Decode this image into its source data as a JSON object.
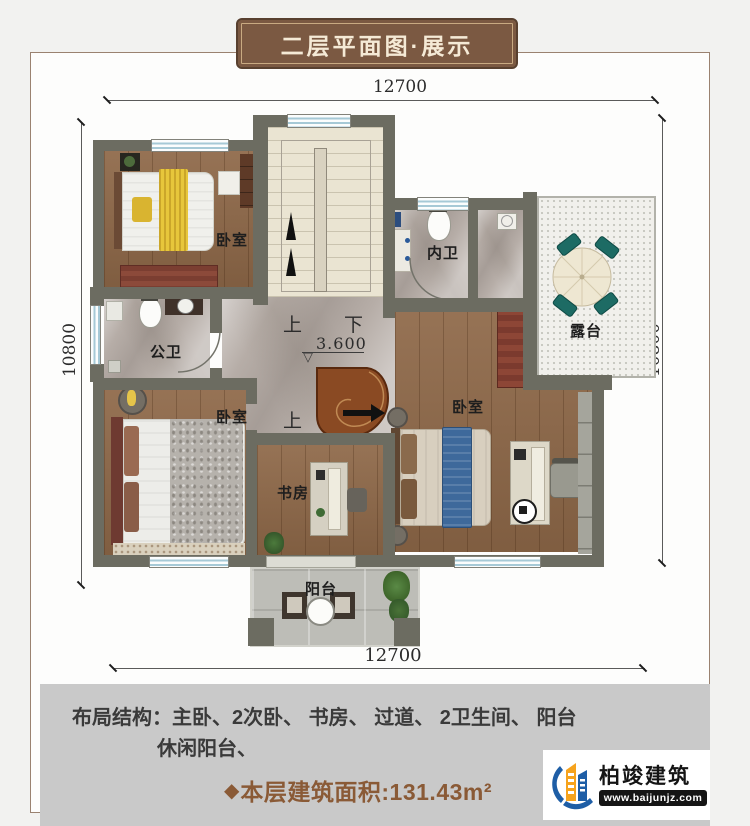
{
  "banner": {
    "title": "二层平面图·展示"
  },
  "dimensions": {
    "top": "12700",
    "bottom": "12700",
    "left": "10800",
    "right": "10800"
  },
  "plan": {
    "rooms": {
      "bedroom_upper_left": "卧室",
      "inner_bath": "内卫",
      "terrace": "露台",
      "public_bath": "公卫",
      "bedroom_lower_left": "卧室",
      "study": "书房",
      "master_bedroom": "卧室",
      "balcony": "阳台"
    },
    "stairs": {
      "up": "上",
      "down": "下",
      "elevation": "3.600",
      "spiral_up": "上"
    }
  },
  "symbols": {
    "elevation_marker": "▽",
    "area_diamond": "◆"
  },
  "footer": {
    "layout_label": "布局结构：",
    "layout_items": "主卧、2次卧、 书房、 过道、 2卫生间、 阳台",
    "layout_items_line2": "休闲阳台、",
    "area_text": "本层建筑面积:131.43m²"
  },
  "logo": {
    "company": "柏竣建筑",
    "website": "www.baijunjz.com"
  },
  "colors": {
    "wall": "#6c6c61",
    "banner": "#7b5942",
    "accent_brown": "#8a5a36",
    "panel": "#c9c9c9",
    "logo_blue": "#1e5ea6",
    "logo_orange": "#f6a31d"
  }
}
